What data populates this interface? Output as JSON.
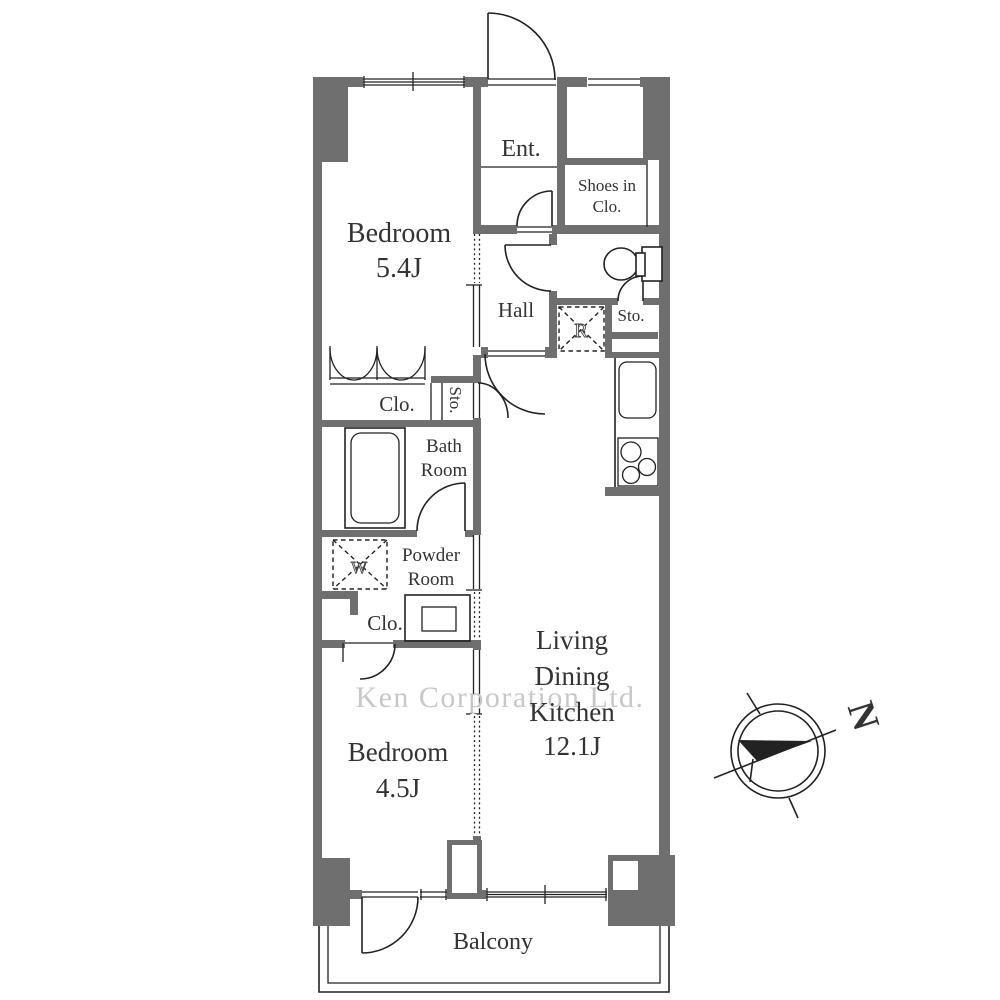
{
  "colors": {
    "wall": "#6f6f6f",
    "line": "#222222",
    "text": "#333333",
    "watermark": "#c8c8c8"
  },
  "rooms": {
    "bedroom_upper": {
      "name": "Bedroom",
      "size": "5.4J"
    },
    "entrance": {
      "label": "Ent."
    },
    "shoes_in_closet": {
      "line1": "Shoes in",
      "line2": "Clo."
    },
    "hall": {
      "label": "Hall"
    },
    "refrigerator_space": {
      "label": "R"
    },
    "storage_by_wc": {
      "label": "Sto."
    },
    "closet_upper": {
      "label": "Clo."
    },
    "storage_mid": {
      "label": "Sto."
    },
    "bathroom": {
      "line1": "Bath",
      "line2": "Room"
    },
    "washer_space": {
      "label": "W"
    },
    "powder_room": {
      "line1": "Powder",
      "line2": "Room"
    },
    "closet_lower": {
      "label": "Clo."
    },
    "ldk": {
      "line1": "Living",
      "line2": "Dining",
      "line3": "Kitchen",
      "size": "12.1J"
    },
    "bedroom_lower": {
      "name": "Bedroom",
      "size": "4.5J"
    },
    "balcony": {
      "label": "Balcony"
    }
  },
  "watermark": {
    "text": "Ken Corporation Ltd."
  },
  "compass": {
    "north_label": "N"
  }
}
